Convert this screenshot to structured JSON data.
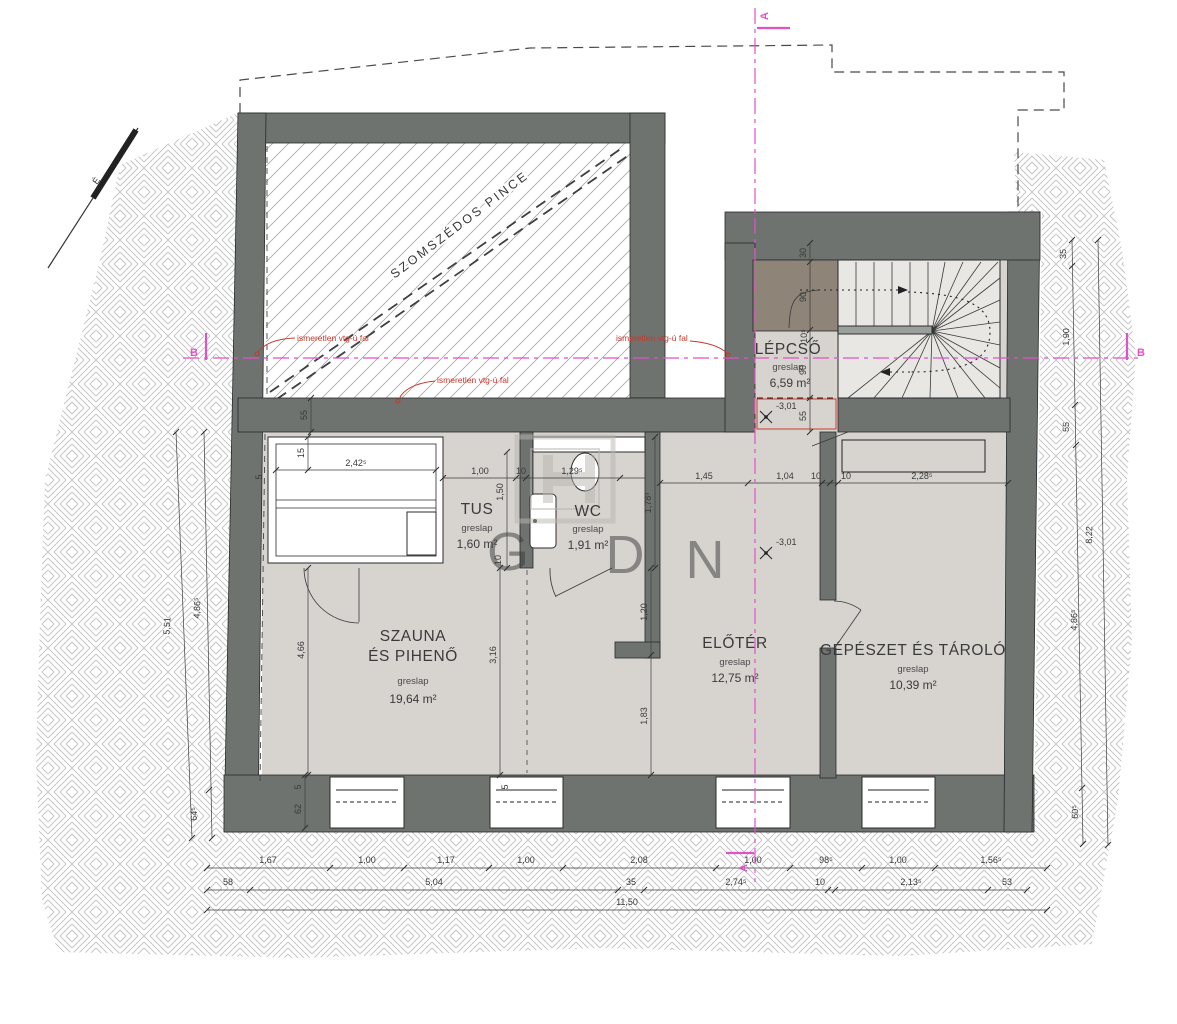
{
  "drawing": {
    "watermark_letters": [
      "G",
      "D",
      "N"
    ],
    "north_label": "É",
    "neighbor_area_label": "SZOMSZÉDOS PINCE",
    "section_a": "A",
    "section_b": "B",
    "wall_note": "ismeretlen vtg-ú fal",
    "level_mark": "-3,01"
  },
  "rooms": {
    "sauna": {
      "l1": "SZAUNA",
      "l2": "ÉS  PIHENŐ",
      "mat": "greslap",
      "area": "19,64 m²"
    },
    "tus": {
      "name": "TUS",
      "mat": "greslap",
      "area": "1,60 m²"
    },
    "wc": {
      "name": "WC",
      "mat": "greslap",
      "area": "1,91 m²"
    },
    "eloter": {
      "name": "ELŐTÉR",
      "mat": "greslap",
      "area": "12,75 m²"
    },
    "gepeszet": {
      "name": "GÉPÉSZET ÉS TÁROLÓ",
      "mat": "greslap",
      "area": "10,39 m²"
    },
    "lepcso": {
      "name": "LÉPCSŐ",
      "mat": "greslap",
      "area": "6,59 m²"
    }
  },
  "dims": {
    "row1": [
      "1,67",
      "1,00",
      "1,17",
      "1,00",
      "2,08",
      "1,00",
      "98⁵",
      "1,00",
      "1,56⁵"
    ],
    "row2": [
      "58",
      "5,04",
      "35",
      "2,74⁵",
      "10",
      "2,13⁵",
      "53"
    ],
    "total": "11,50",
    "left": [
      "5,51",
      "4,86⁵",
      "64⁵"
    ],
    "right": [
      "35",
      "1,90",
      "55",
      "4,86⁵",
      "60⁵",
      "8,22"
    ],
    "stair": [
      "30",
      "90",
      "10⁵",
      "90",
      "55"
    ],
    "top_row": [
      "2,42⁵",
      "1,00",
      "10",
      "1,29⁵",
      "1,45",
      "1,04",
      "10",
      "10",
      "2,28⁵"
    ],
    "vertical": [
      "15",
      "5",
      "55",
      "1,50",
      "10",
      "1,78³",
      "1,20",
      "1,83",
      "3,16",
      "4,66"
    ],
    "window": [
      "5",
      "62",
      "5"
    ]
  },
  "colors": {
    "wall": "#6f7370",
    "floor": "#d7d4d0",
    "stair_floor": "#e9e7e3",
    "landing": "#8e8578",
    "magenta": "#e052c8",
    "annotation_red": "#c3392b",
    "hatch": "#c3c3c3"
  }
}
